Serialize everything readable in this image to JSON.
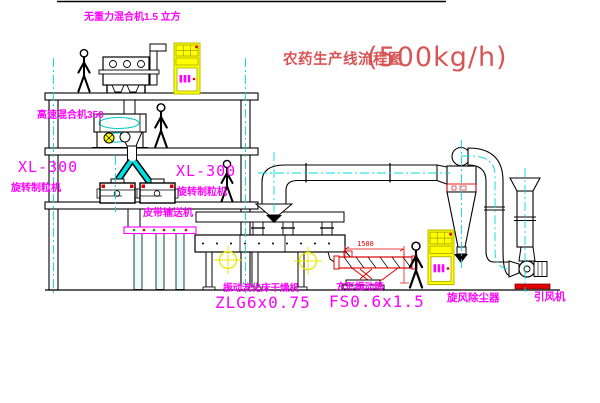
{
  "title": {
    "text": "农药生产线流程图",
    "capacity": "(500kg/h)"
  },
  "labels": {
    "gravity_mixer": "无重力混合机1.5 立方",
    "high_speed_mixer": "高速混合机350",
    "granulator_left_model": "XL-300",
    "granulator_left_name": "旋转制粒机",
    "granulator_right_model": "XL-300",
    "granulator_right_name": "旋转制粒机",
    "belt_conveyor": "皮带输送机",
    "fluid_bed_dryer_name": "振动流化床干燥机",
    "fluid_bed_dryer_model": "ZLG6x0.75",
    "vibrating_screen_name": "方形振动筛",
    "vibrating_screen_model": "FS0.6x1.5",
    "cyclone_dust_collector": "旋风除尘器",
    "induced_draft_fan": "引风机"
  },
  "dimensions": {
    "screen_length": "1500"
  },
  "colors": {
    "label_magenta": "#ff00ff",
    "title_red": "#d85555",
    "cad_red": "#e00000",
    "centerline_cyan": "#00dcdc",
    "cabinet_yellow": "#ffff00",
    "line_black": "#000000"
  }
}
